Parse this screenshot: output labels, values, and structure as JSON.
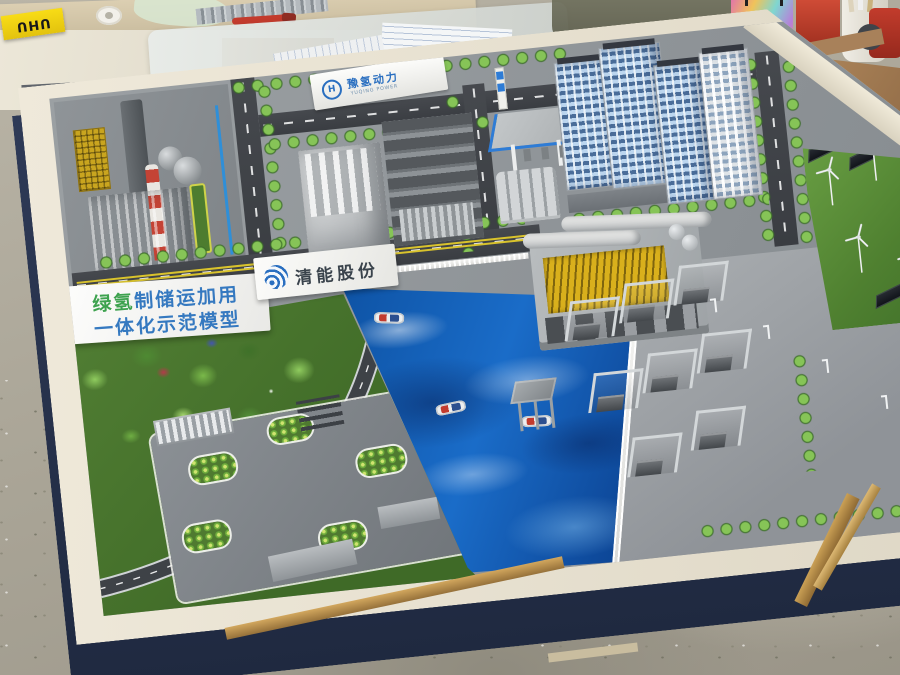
{
  "signs": {
    "banner": {
      "line1_green": "绿氢",
      "line1_blue": "制储运加用",
      "line2": "一体化示范模型"
    },
    "billboard": {
      "company": "清能股份"
    },
    "gate": {
      "logo_letter": "H",
      "company": "豫氢动力",
      "subtitle": "YUQING POWER"
    },
    "workshop": {
      "glue_box": "UHU"
    }
  },
  "colors": {
    "water": "#1464b8",
    "lawn": "#5d9340",
    "asphalt": "#3e4247",
    "table_frame": "#e9e3d3",
    "table_skirt": "#2a3550",
    "banner_blue": "#3579c0",
    "banner_green": "#3da24e",
    "logo_blue": "#2a6fc0",
    "chimney_red": "#c4402f",
    "storage_tube_yellow": "#d9b01c",
    "gas_canopy_trim": "#2e7cd6"
  }
}
